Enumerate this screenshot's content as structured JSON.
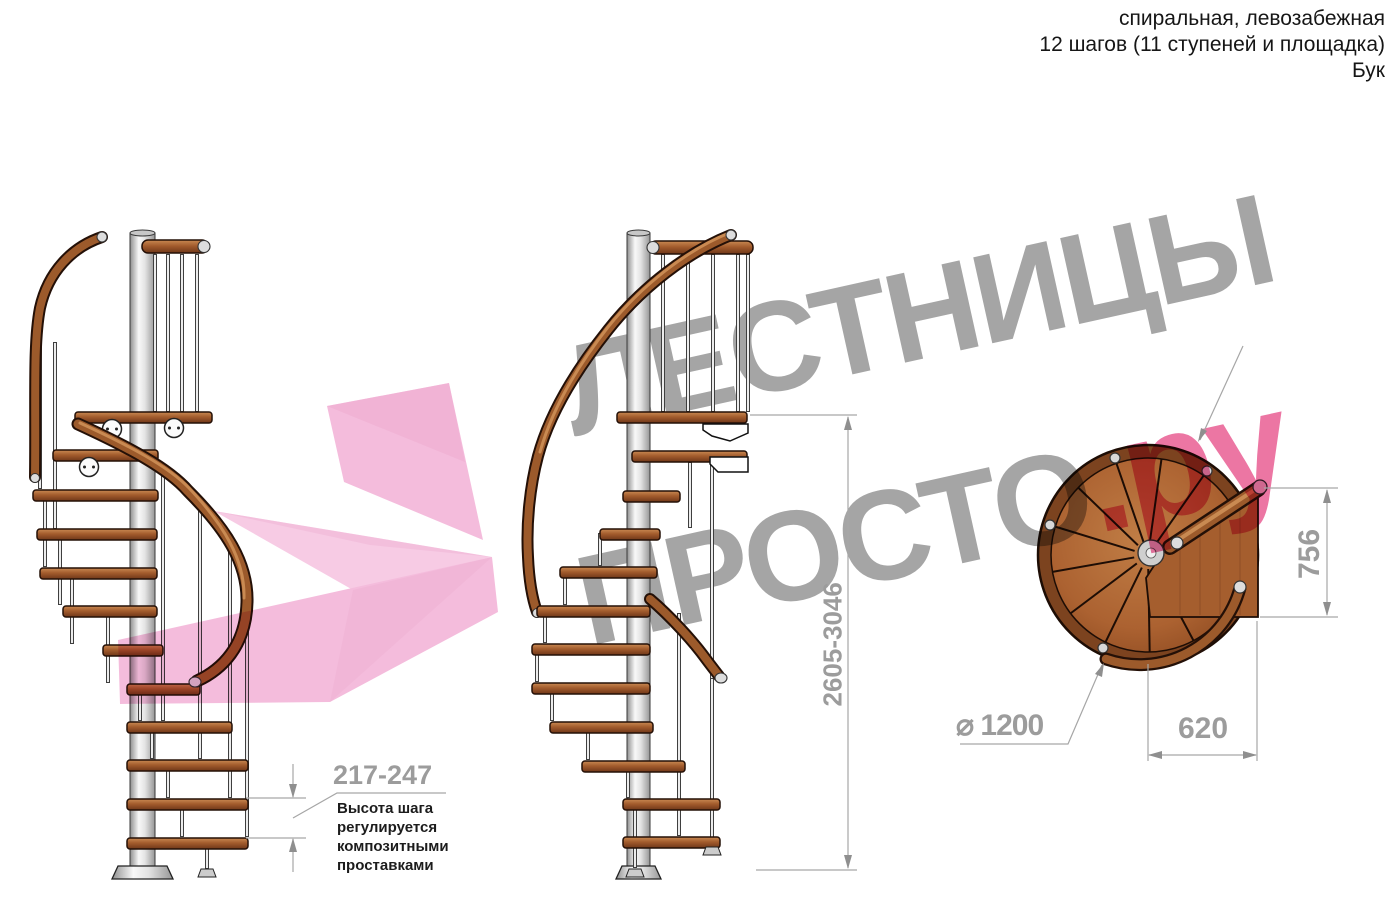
{
  "header": {
    "line1": "спиральная, левозабежная",
    "line2": "12 шагов (11 ступеней и площадка)",
    "line3": "Бук"
  },
  "watermark": {
    "line1": "ЛЕСТНИЦЫ",
    "line2_gray": "ПРОСТО",
    "line2_pink": ".ру",
    "gray_color": "#9e9e9e",
    "pink_color": "#eb6b9c"
  },
  "dimensions": {
    "total_height": "2605-3046",
    "landing_depth": "756",
    "landing_width": "620",
    "diameter": "⌀ 1200",
    "step_height": "217-247",
    "step_height_note": "Высота шага\nрегулируется\nкомпозитными\nпроставками"
  },
  "colors": {
    "wood": "#a35c2d",
    "wood_dark": "#7c431f",
    "outline": "#241007",
    "pole": "#d9d9d9",
    "dim_line": "#a6a6a6",
    "dim_text": "#9c9c9c",
    "arrow_pink": "#f3b3d7"
  }
}
